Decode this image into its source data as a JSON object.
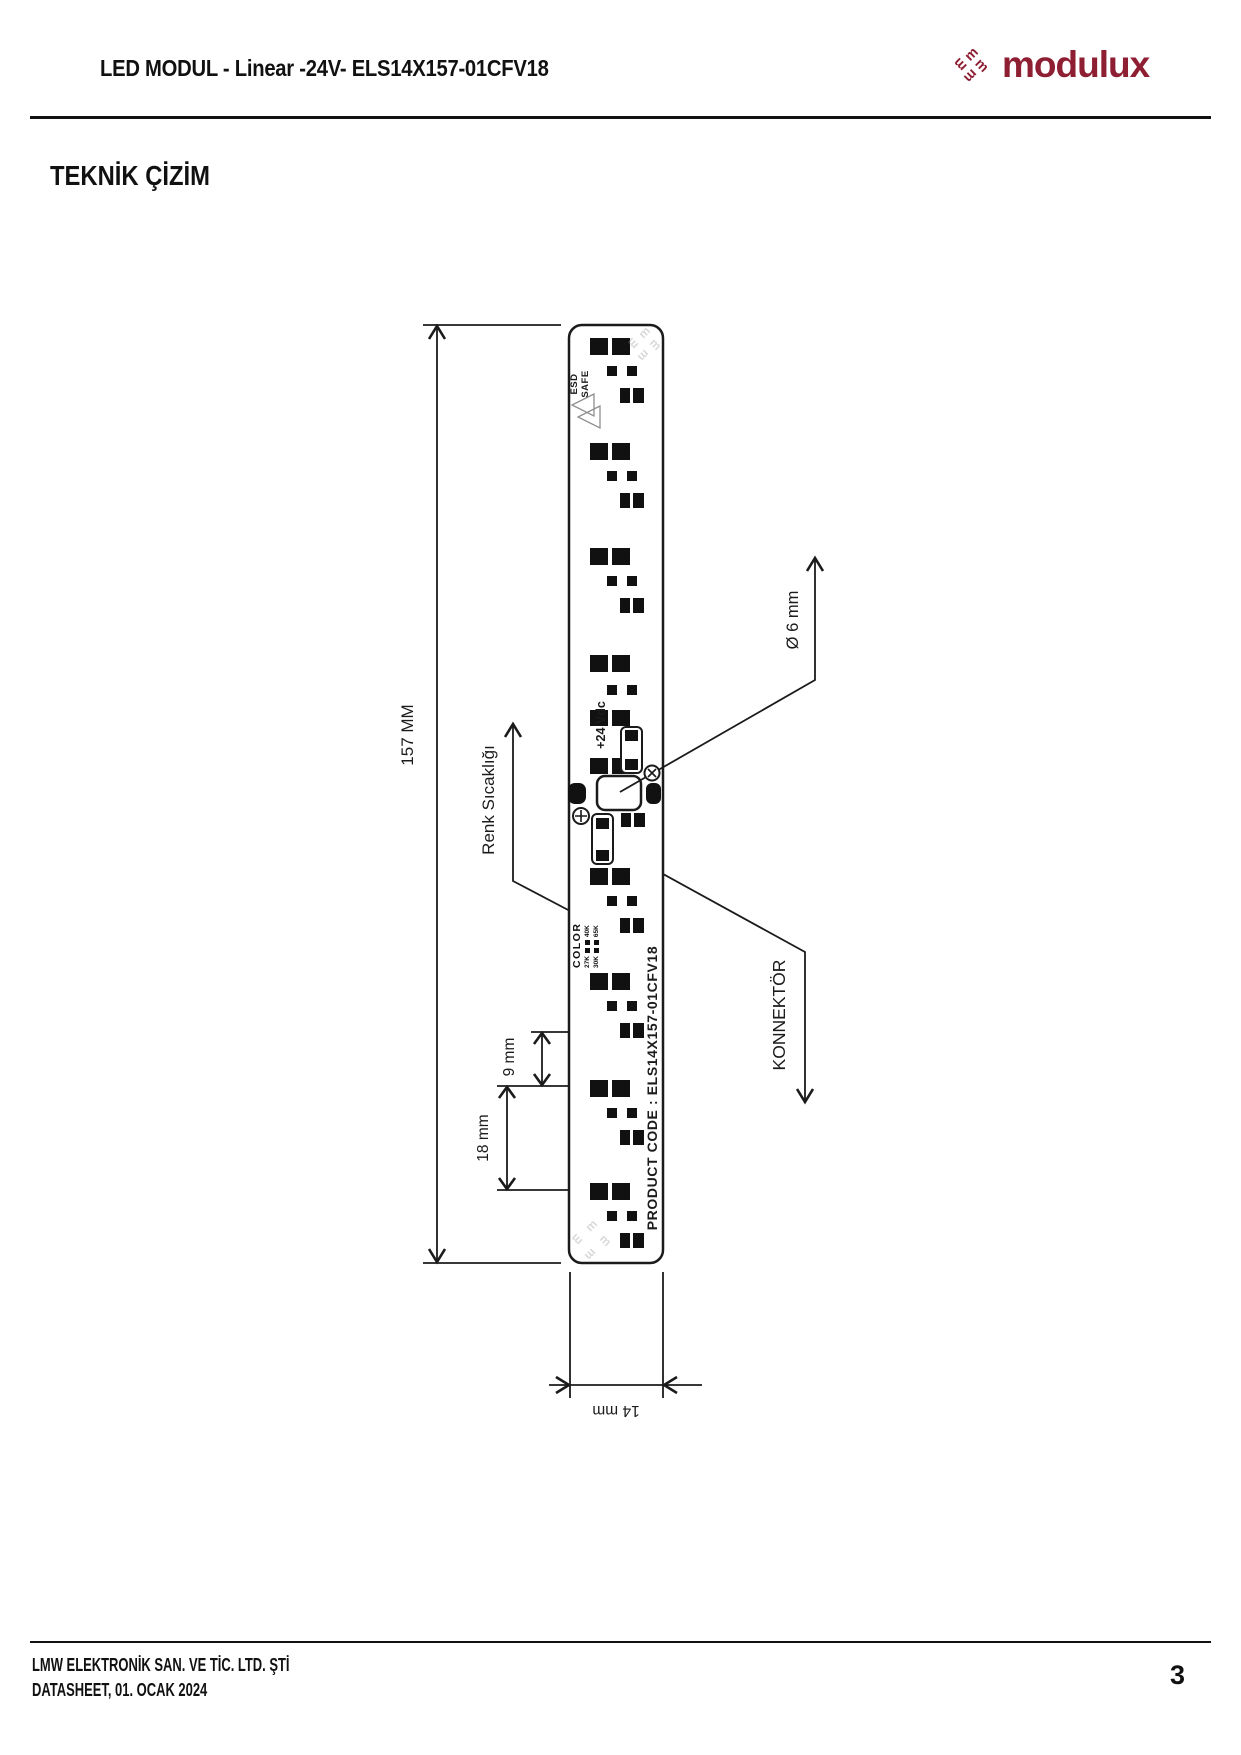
{
  "header": {
    "title": "LED MODUL - Linear -24V- ELS14X157-01CFV18",
    "brand": "modulux",
    "brand_icon_letter": "m",
    "brand_color": "#8e1f33"
  },
  "section": {
    "title": "TEKNİK ÇİZİM"
  },
  "drawing": {
    "labels": {
      "length": "157 MM",
      "width": "14 mm",
      "pitch": "18 mm",
      "half_pitch": "9 mm",
      "hole_dia": "Ø 6 mm",
      "color_temp": "Renk Sıcaklığı",
      "connector": "KONNEKTÖR"
    },
    "board": {
      "esd_line1": "ESD",
      "esd_line2": "SAFE",
      "voltage": "+24 Vdc",
      "product_code": "PRODUCT CODE : ELS14X157-01CFV18",
      "color_block": {
        "title": "COLOR",
        "options": [
          "27K",
          "40K",
          "30K",
          "65K"
        ]
      }
    },
    "led_units_y": [
      338,
      443,
      548,
      868,
      973,
      1080,
      1183
    ]
  },
  "footer": {
    "company": "LMW ELEKTRONİK SAN. VE TİC. LTD. ŞTİ",
    "datasheet": "DATASHEET, 01. OCAK 2024",
    "page": "3"
  }
}
